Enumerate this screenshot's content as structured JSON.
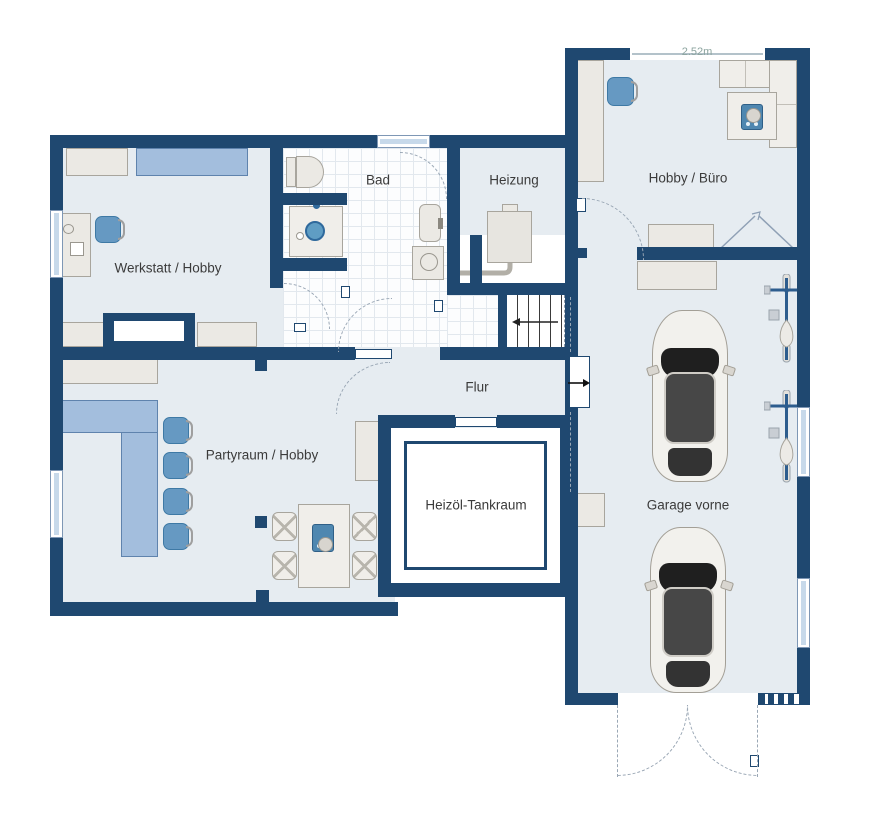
{
  "plan": {
    "dimension_label": "2.52m",
    "rooms": {
      "werkstatt": {
        "label": "Werkstatt / Hobby"
      },
      "bad": {
        "label": "Bad"
      },
      "heizung": {
        "label": "Heizung"
      },
      "hobby_buero": {
        "label": "Hobby / Büro"
      },
      "flur": {
        "label": "Flur"
      },
      "partyraum": {
        "label": "Partyraum / Hobby"
      },
      "tankraum": {
        "label": "Heizöl-Tankraum"
      },
      "garage": {
        "label": "Garage vorne"
      }
    },
    "colors": {
      "wall": "#1f4870",
      "room_fill": "#e6ecf1",
      "tile_fill": "#fcfdfe",
      "furniture_fill": "#ebe9e4",
      "furniture_border": "#a8a59d",
      "accent_blue": "#6699c2",
      "bar_blue": "#a3bedd",
      "dimension_text": "#8ca49f"
    }
  }
}
